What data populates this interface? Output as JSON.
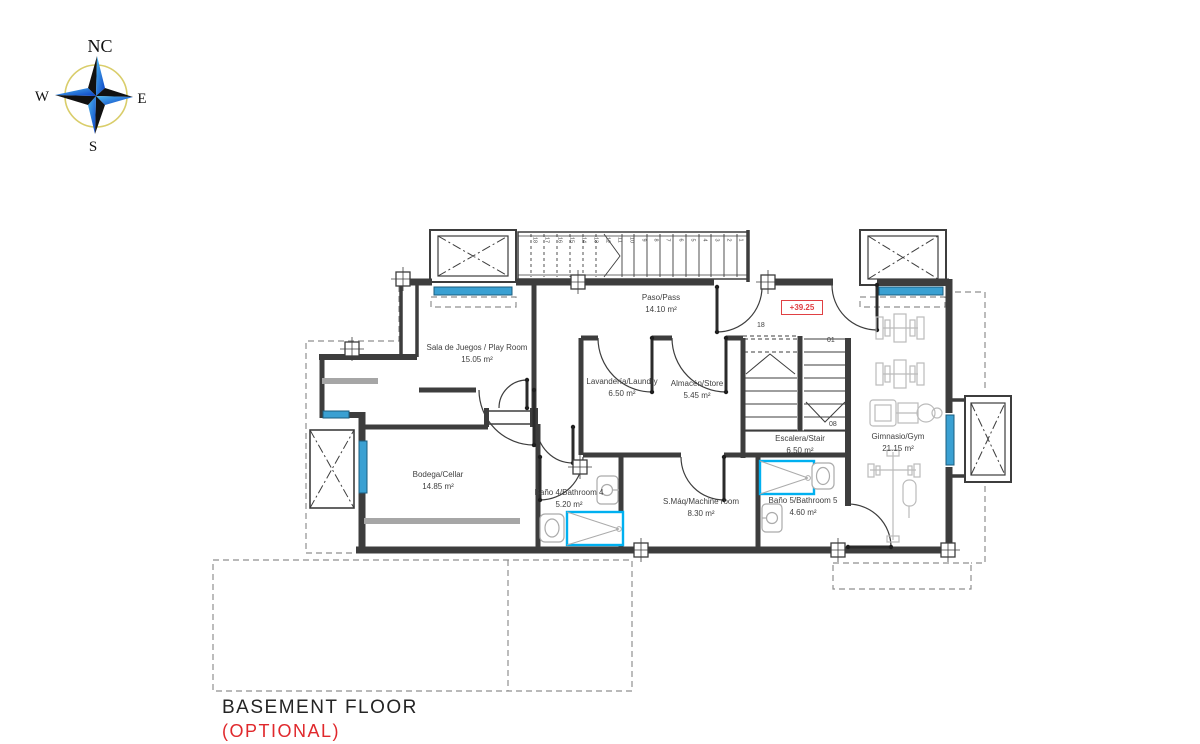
{
  "compass": {
    "north": "NC",
    "west": "W",
    "east": "E",
    "south": "S"
  },
  "level_marker": "+39.25",
  "rooms": [
    {
      "name": "Sala de Juegos / Play Room",
      "area": "15.05 m²"
    },
    {
      "name": "Paso/Pass",
      "area": "14.10 m²"
    },
    {
      "name": "Lavandería/Laundry",
      "area": "6.50 m²"
    },
    {
      "name": "Almacén/Store",
      "area": "5.45 m²"
    },
    {
      "name": "Escalera/Stair",
      "area": "6.50 m²"
    },
    {
      "name": "Gimnasio/Gym",
      "area": "21.15 m²"
    },
    {
      "name": "Bodega/Cellar",
      "area": "14.85 m²"
    },
    {
      "name": "Baño 4/Bathroom 4",
      "area": "5.20 m²"
    },
    {
      "name": "S.Máq/Machine room",
      "area": "8.30 m²"
    },
    {
      "name": "Baño 5/Bathroom 5",
      "area": "4.60 m²"
    }
  ],
  "stair": {
    "top_step": "18",
    "first_step": "01",
    "mid_step": "08",
    "exterior_treads": [
      "1",
      "2",
      "3",
      "4",
      "5",
      "6",
      "7",
      "8",
      "9",
      "10",
      "11",
      "12",
      "13",
      "14",
      "15",
      "16",
      "17",
      "18"
    ]
  },
  "title": {
    "main": "BASEMENT FLOOR",
    "sub": "(OPTIONAL)"
  },
  "colors": {
    "wall": "#3d3d3d",
    "window_blue": "#3aa0d2",
    "shower_cyan": "#00b0f0",
    "accent_red": "#e0282c",
    "dashed_gray": "#8f8f8f",
    "equipment_gray": "#bbbbbb",
    "compass_ring_yellow": "#d9cd6a",
    "compass_blue": "#1580c8"
  }
}
